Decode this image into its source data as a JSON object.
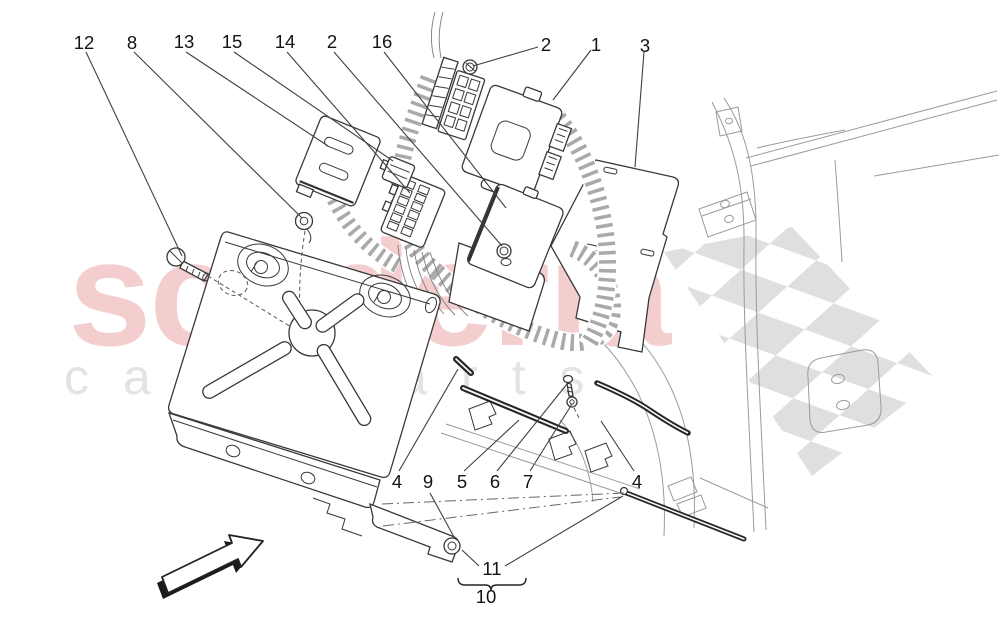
{
  "watermark": {
    "brand": "scuderia",
    "tagline": "car parts",
    "brand_color": "#eec5c5",
    "tagline_color": "#e3e3e3",
    "checker_color": "#d2d2d2"
  },
  "diagram": {
    "type": "exploded-parts-diagram",
    "subject": "engine electronic control units and wiring-bracket assembly",
    "line_color": "#3c3c3c",
    "callouts": {
      "c12": {
        "label": "12"
      },
      "c8": {
        "label": "8"
      },
      "c13": {
        "label": "13"
      },
      "c15": {
        "label": "15"
      },
      "c14": {
        "label": "14"
      },
      "c2a": {
        "label": "2"
      },
      "c16": {
        "label": "16"
      },
      "c2b": {
        "label": "2"
      },
      "c1": {
        "label": "1"
      },
      "c3": {
        "label": "3"
      },
      "c4a": {
        "label": "4"
      },
      "c9": {
        "label": "9"
      },
      "c5": {
        "label": "5"
      },
      "c6": {
        "label": "6"
      },
      "c7": {
        "label": "7"
      },
      "c4b": {
        "label": "4"
      },
      "c11": {
        "label": "11"
      },
      "c10": {
        "label": "10"
      }
    }
  }
}
